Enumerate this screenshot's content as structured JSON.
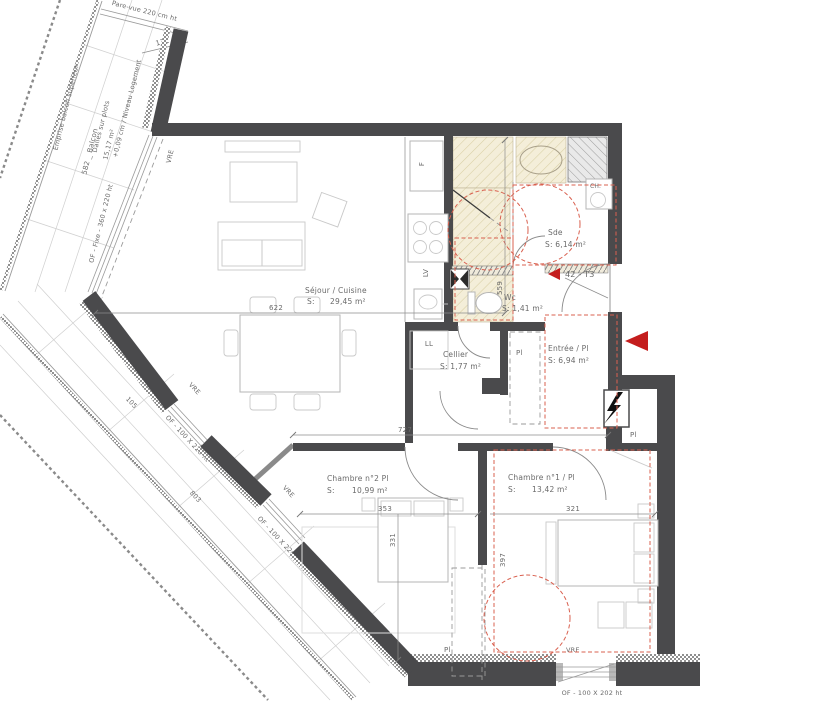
{
  "drawing": {
    "unit_label": "42 - T3",
    "rooms": {
      "sejour": {
        "name": "Séjour / Cuisine",
        "s": "S:",
        "area": "29,45 m²"
      },
      "sde": {
        "name": "Sde",
        "area": "S: 6,14 m²"
      },
      "wc": {
        "name": "Wc",
        "area": "S: 1,41 m²"
      },
      "cellier": {
        "name": "Cellier",
        "area": "S: 1,77 m²"
      },
      "entree": {
        "name": "Entrée / Pl",
        "area": "S: 6,94 m²"
      },
      "chambre2": {
        "name": "Chambre n°2  Pl",
        "s": "S:",
        "area": "10,99 m²"
      },
      "chambre1": {
        "name": "Chambre n°1 / Pl",
        "s": "S:",
        "area": "13,42 m²"
      }
    },
    "balcony": {
      "emprise": "Emprise balcon supérieur",
      "name": "582 _ Balcon",
      "floor": "Dalles sur plots",
      "area": "15,17 m²",
      "level": "+0,09 cm / Niveau Logement",
      "pare_vue": "Pare-vue 220 cm ht"
    },
    "windows": {
      "fixe": "OF - Fixe - 360 x 220 ht",
      "of_a": "OF - 100 X 220 ht",
      "of_b": "OF - 100 X 220 ht",
      "of_c": "OF - 100 X 202 ht",
      "vre": "VRE"
    },
    "fixtures": {
      "fridge": "F",
      "dishwasher": "LV",
      "washing": "LL",
      "heater": "CH.",
      "closet": "Pl"
    },
    "dims": {
      "d131": "131",
      "d559": "559",
      "d622": "622",
      "d727": "727",
      "d353": "353",
      "d331": "331",
      "d321": "321",
      "d397": "397",
      "d105": "105",
      "d803": "803"
    },
    "colors": {
      "wall": "#4a4a4c",
      "red": "#c41d1d",
      "red_dash": "#d9604f",
      "beige": "#f4eed9",
      "gray_text": "#6a6a6a"
    }
  }
}
